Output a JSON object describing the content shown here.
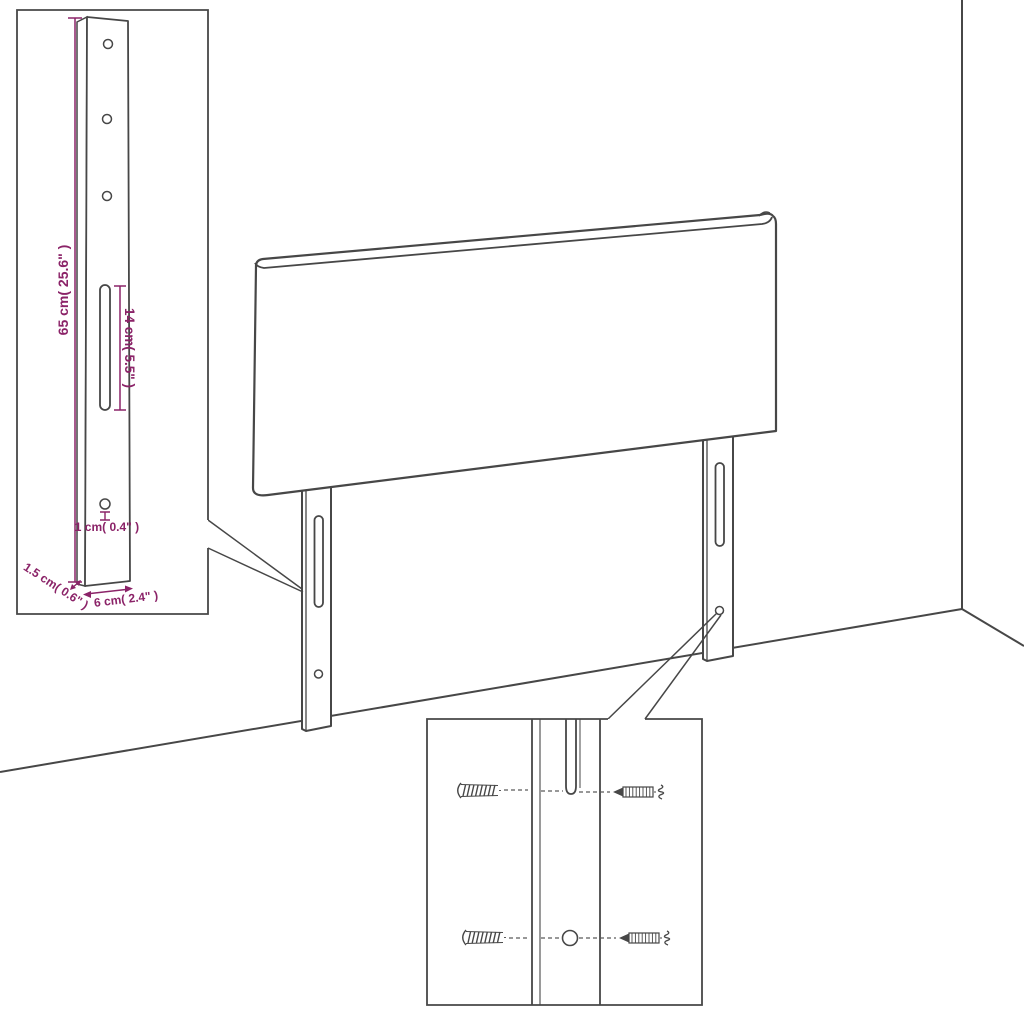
{
  "figure": {
    "type": "product-dimension-diagram",
    "subject": "upholstered headboard with two slotted mounting legs, wall-corner backdrop, detail insets",
    "background_color": "#ffffff",
    "line_color": "#474747",
    "dimension_color": "#8b2368"
  },
  "labels": {
    "leg_height": "65 cm( 25.6\" )",
    "slot_length": "14 cm( 5.5\" )",
    "hole_diameter": "1 cm( 0.4\" )",
    "leg_depth": "1.5 cm( 0.6\" )",
    "leg_width": "6 cm( 2.4\" )"
  }
}
